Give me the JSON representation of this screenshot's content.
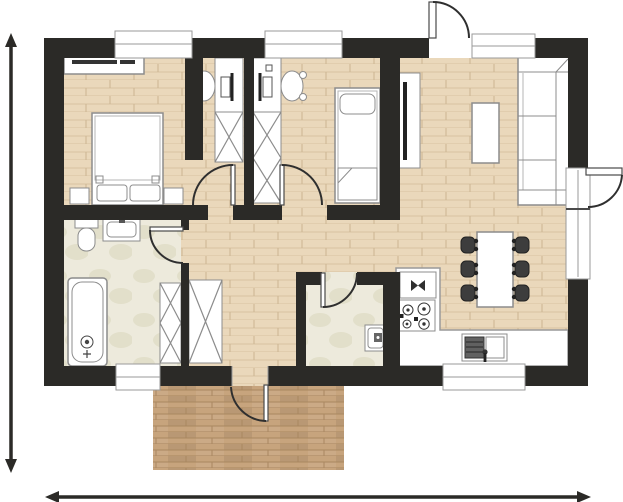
{
  "meta": {
    "kind": "architectural-floor-plan",
    "canvas": {
      "width": 623,
      "height": 502
    },
    "has_text_labels": false
  },
  "colors": {
    "bg": "#ffffff",
    "wall": "#2b2a27",
    "wood-base": "#ead8bb",
    "wood-line": "#d8c2a1",
    "wood-seam": "#ccb592",
    "terrace-base": "#c7a47d",
    "terrace-line": "#a98760",
    "tile-base": "#edeadc",
    "tile-blob": "#e2dfca",
    "outline": "#8c8c8c",
    "outline-dark": "#4a4a4a",
    "detail-dark": "#2f2f2f",
    "counter-outline": "#999999",
    "chair-dark": "#3d3d3d",
    "sink-basin": "#616161"
  },
  "rooms": [
    {
      "id": "bedroom-master",
      "floor": "wood",
      "position": "top-left",
      "furniture": [
        "wall-shelf",
        "double-bed",
        "nightstand-left",
        "nightstand-right",
        "desk-a",
        "desk-chair-a",
        "wardrobe-a"
      ]
    },
    {
      "id": "bedroom-second",
      "floor": "wood",
      "position": "top-center",
      "furniture": [
        "desk-b",
        "desk-chair-b",
        "wardrobe-b-double",
        "single-bed"
      ]
    },
    {
      "id": "living-room",
      "floor": "wood",
      "position": "top-right",
      "furniture": [
        "tv-sideboard",
        "tv",
        "coffee-table",
        "corner-sofa"
      ]
    },
    {
      "id": "dining-area",
      "floor": "wood",
      "position": "right",
      "furniture": [
        "dining-table",
        "six-chairs"
      ]
    },
    {
      "id": "kitchen",
      "floor": "wood-with-counter",
      "position": "bottom-right",
      "furniture": [
        "l-shaped-counter",
        "built-in-appliance",
        "four-burner-stove",
        "double-sink"
      ]
    },
    {
      "id": "bathroom",
      "floor": "tile",
      "position": "left",
      "furniture": [
        "toilet",
        "washbasin",
        "bathtub",
        "tall-cabinet-x"
      ]
    },
    {
      "id": "wc",
      "floor": "tile",
      "position": "bottom-center",
      "furniture": [
        "small-washbasin"
      ]
    },
    {
      "id": "hallway",
      "floor": "wood",
      "position": "center",
      "furniture": [
        "hall-wardrobe-x"
      ]
    },
    {
      "id": "terrace",
      "floor": "dark-wood-deck",
      "position": "bottom-outside",
      "furniture": []
    }
  ],
  "openings": {
    "windows": [
      "bedroom-master-top",
      "bedroom-second-top",
      "entrance-sidelight",
      "bathroom-bottom",
      "kitchen-bottom",
      "living-right-lower"
    ],
    "exterior_doors": [
      "entrance-top",
      "living-right",
      "terrace-bottom"
    ],
    "interior_doors": [
      "bedroom-master",
      "bedroom-second",
      "bathroom",
      "wc"
    ]
  },
  "dimension_annotations": {
    "left_arrow": {
      "orientation": "vertical",
      "double_headed": true,
      "label": ""
    },
    "bottom_arrow": {
      "orientation": "horizontal",
      "double_headed": true,
      "label": ""
    }
  }
}
